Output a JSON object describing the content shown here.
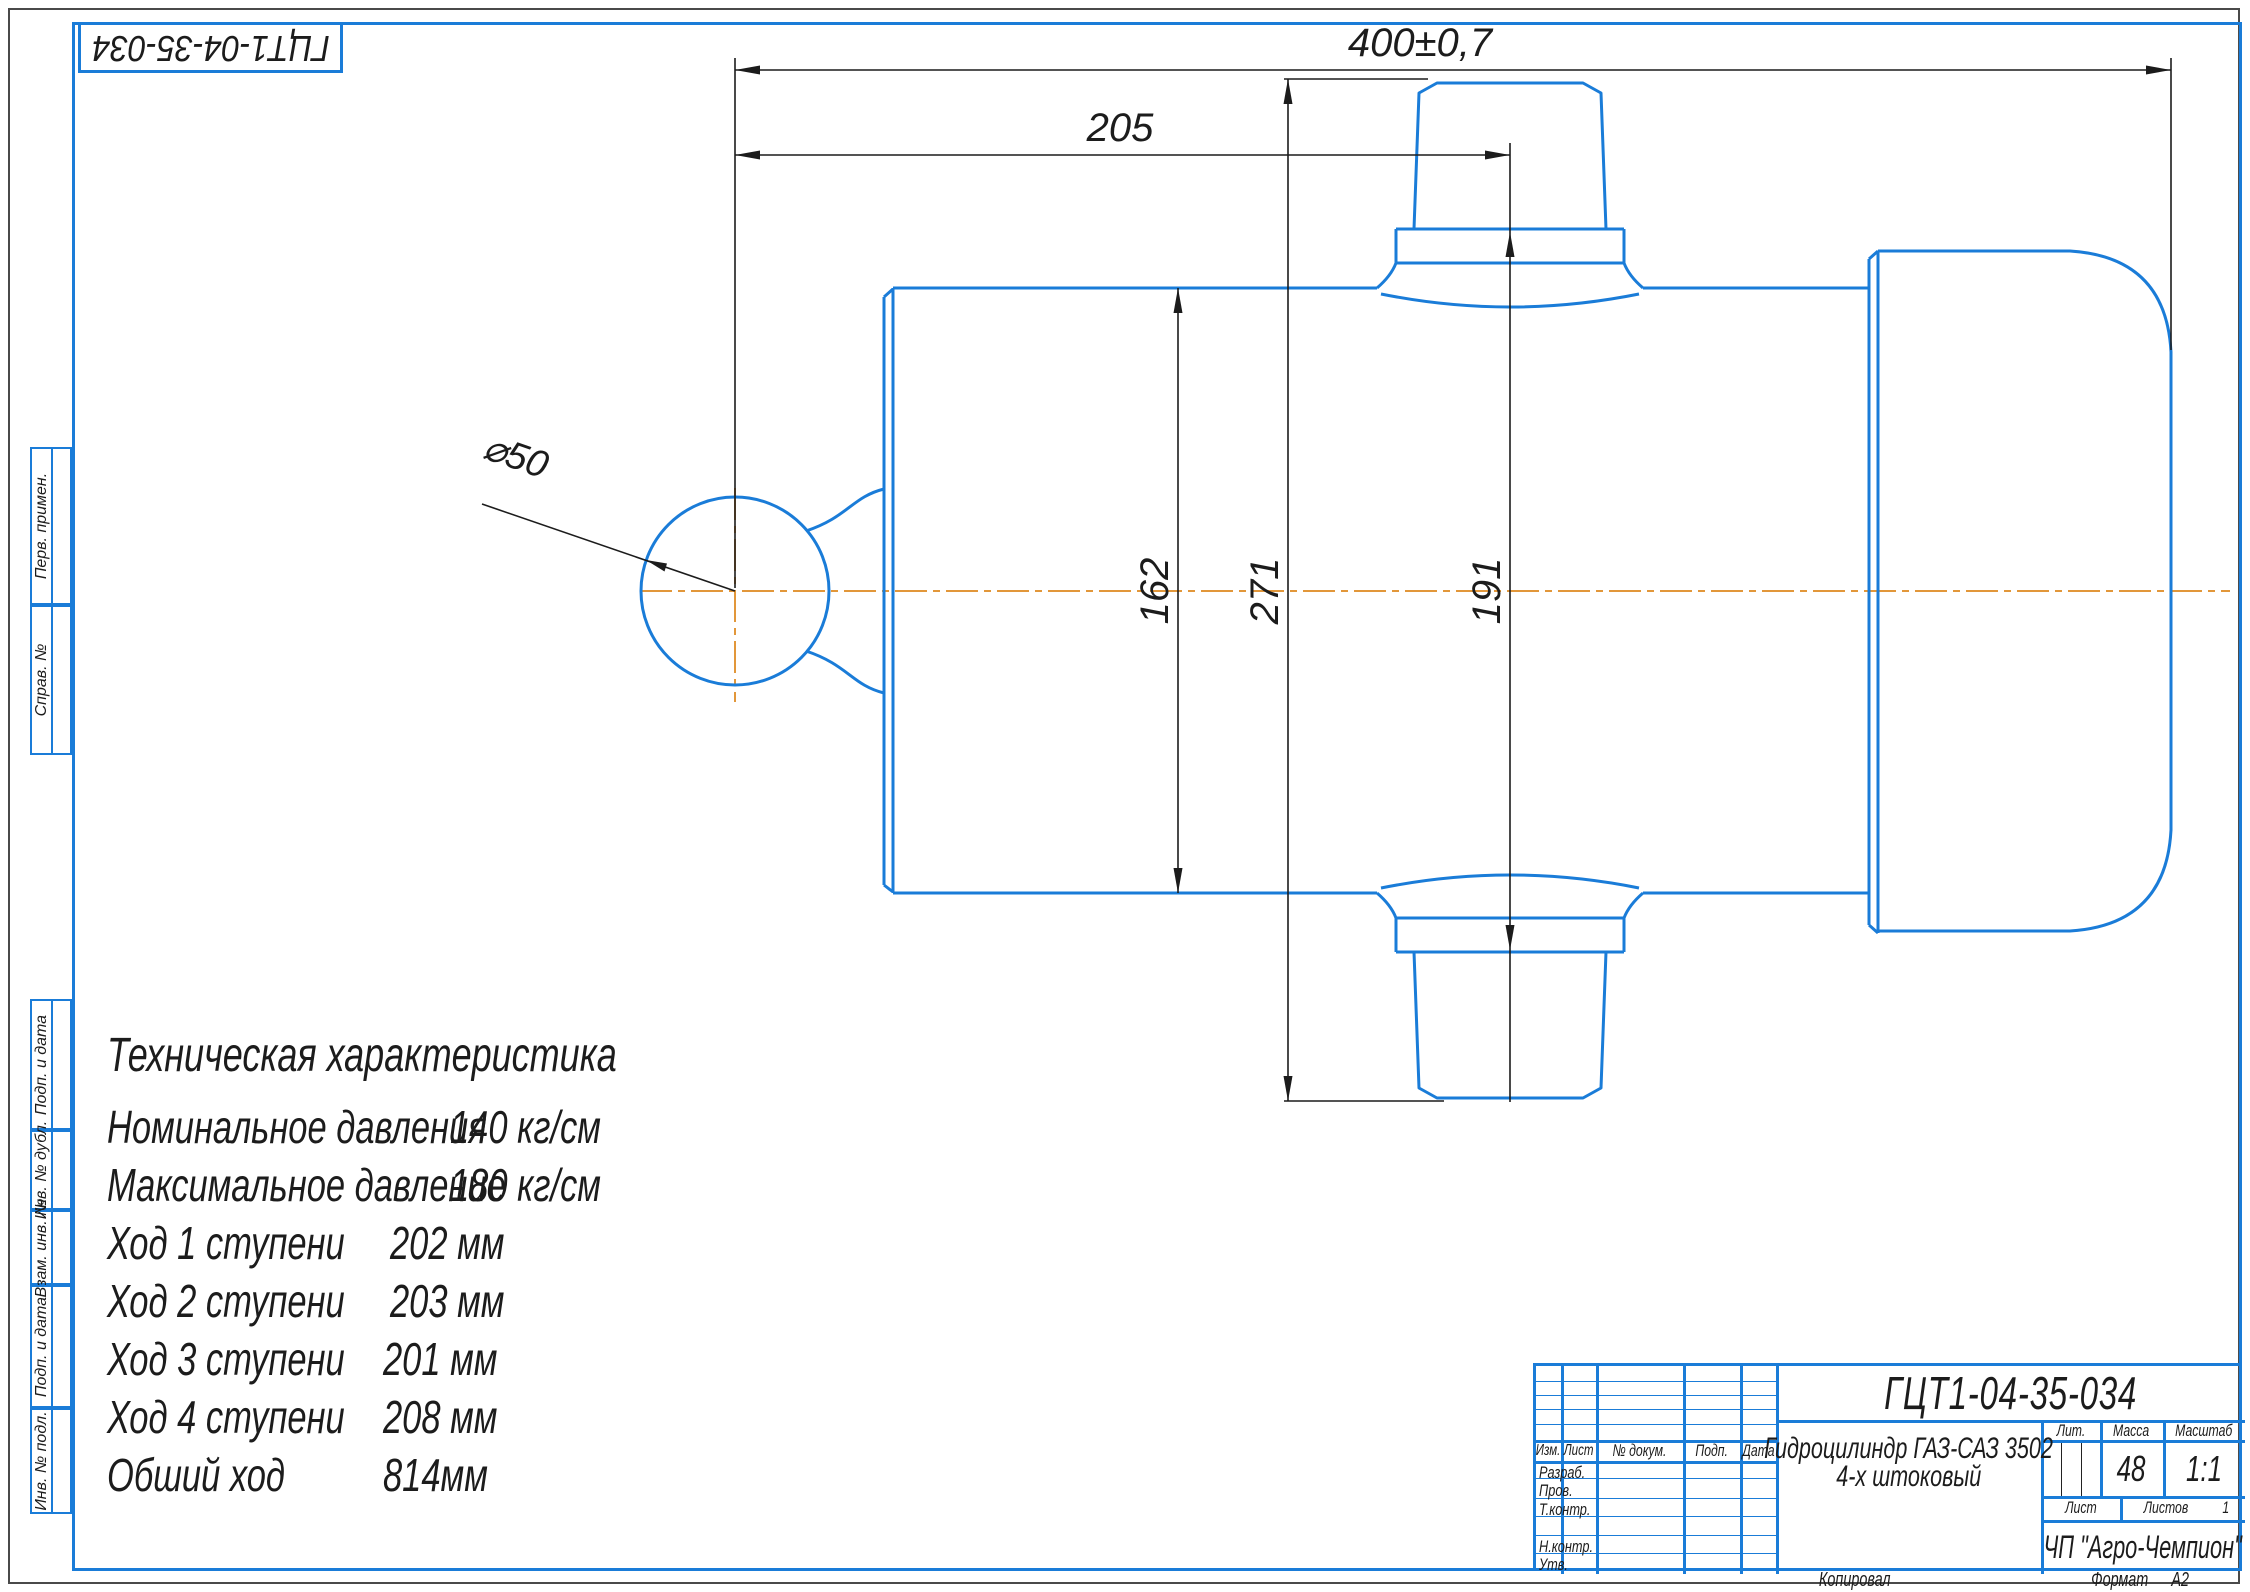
{
  "colors": {
    "line_blue": "#1a7cd8",
    "centerline_orange": "#e2973a",
    "dim_black": "#1c1c1c"
  },
  "corner_designation": "ГЦТ1-04-35-034",
  "margin_labels": [
    "Перв. примен.",
    "Справ. №",
    "Подп. и дата",
    "Инв. № дубл.",
    "Взам. инв. №",
    "Подп. и дата",
    "Инв. № подл."
  ],
  "dims": {
    "overall": "400±0,7",
    "to_port": "205",
    "body": "162",
    "over_fittings": "271",
    "across_bosses": "191",
    "ball": "⌀50"
  },
  "tech_specs": {
    "title": "Техническая характеристика",
    "rows": [
      {
        "label": "Номинальное давления",
        "value": "140 кг/см"
      },
      {
        "label": "Максимальное давление",
        "value": "180 кг/см"
      },
      {
        "label": "Ход 1 ступени",
        "value": "202 мм"
      },
      {
        "label": "Ход  2 ступени",
        "value": "203 мм"
      },
      {
        "label": "Ход  3 ступени",
        "value": "201 мм"
      },
      {
        "label": "Ход  4 ступени",
        "value": "208 мм"
      },
      {
        "label": "Обший ход",
        "value": "814мм"
      }
    ]
  },
  "title_block": {
    "doc_number": "ГЦТ1-04-35-034",
    "name_line1": "Гидроцилиндр ГАЗ-САЗ 3502",
    "name_line2": "4-х штоковый",
    "company": "ЧП \"Агро-Чемпион\"",
    "col_izm": "Изм.",
    "col_list": "Лист",
    "col_docnum": "№ докум.",
    "col_podp": "Подп.",
    "col_data": "Дата",
    "row_razrab": "Разраб.",
    "row_prov": "Пров.",
    "row_tkontr": "Т.контр.",
    "row_nkontr": "Н.контр.",
    "row_utv": "Утв.",
    "lit_label": "Лит.",
    "mass_label": "Масса",
    "scale_label": "Масштаб",
    "mass_value": "48",
    "scale_value": "1:1",
    "sheet_label": "Лист",
    "sheets_label": "Листов",
    "sheets_value": "1"
  },
  "bottom_strip": {
    "copied_label": "Копировал",
    "format_label": "Формат",
    "format_value": "А2"
  }
}
